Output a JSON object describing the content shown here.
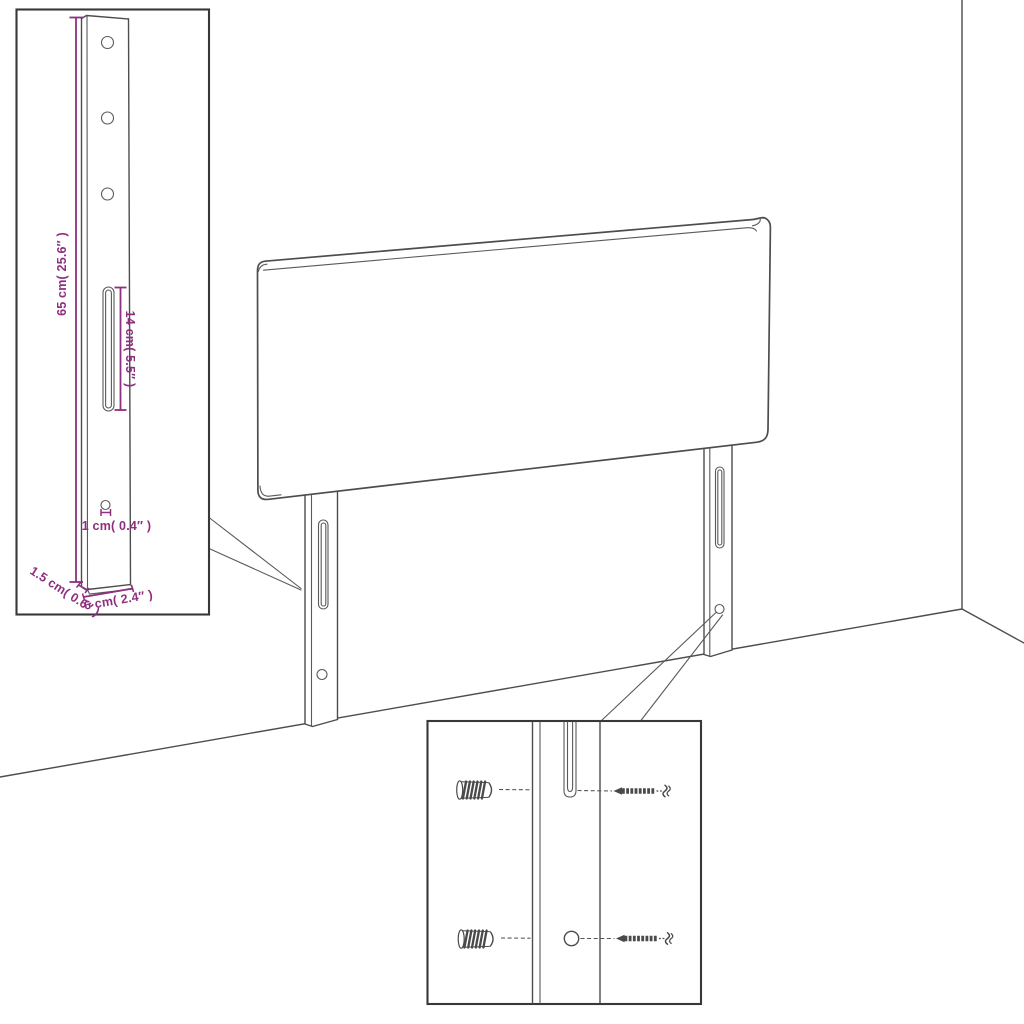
{
  "diagram": {
    "subject": "headboard-assembly-dimension-diagram",
    "colors": {
      "outline": "#4d4d4d",
      "inset_border": "#383838",
      "dimension": "#8e2f7f",
      "background": "#ffffff"
    },
    "leg_detail_inset": {
      "dimensions": {
        "height": "65 cm( 25.6″ )",
        "slot_length": "14 cm( 5.5″ )",
        "hole_diameter": "1 cm( 0.4″ )",
        "thickness": "1.5 cm( 0.6″ )",
        "width": "6 cm( 2.4″ )"
      }
    }
  }
}
